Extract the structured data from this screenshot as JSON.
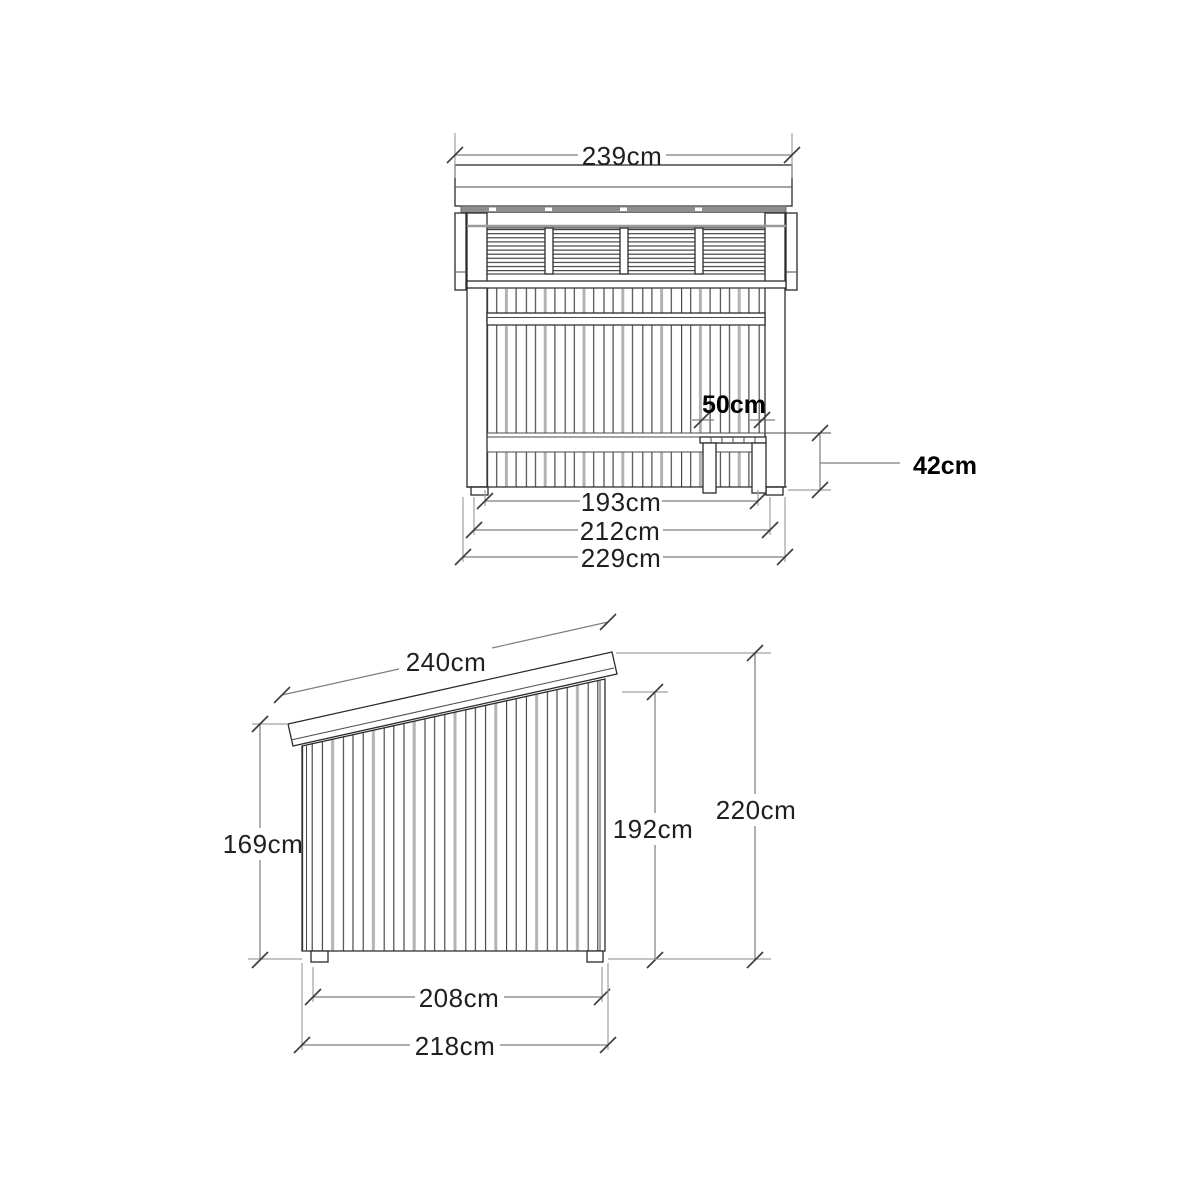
{
  "drawing": {
    "type": "shelter-technical-drawing",
    "views": {
      "front": {
        "dims": {
          "roof_width": "239cm",
          "bench_depth": "50cm",
          "bench_height": "42cm",
          "inner_width": "193cm",
          "frame_width": "212cm",
          "overall_width": "229cm"
        }
      },
      "side": {
        "dims": {
          "roof_length": "240cm",
          "low_side_height": "169cm",
          "opening_height": "192cm",
          "overall_height": "220cm",
          "base_depth": "208cm",
          "overall_depth": "218cm"
        }
      }
    },
    "colors": {
      "background": "#ffffff",
      "object_line": "#2b2b2b",
      "dimension_line": "#7d7d7d",
      "extension_line": "#a0a0a0",
      "gray_plank": "#b3b3b3",
      "roof_strip": "#8e8e8e",
      "text": "#1f1f1f",
      "bold_text": "#000000"
    }
  }
}
